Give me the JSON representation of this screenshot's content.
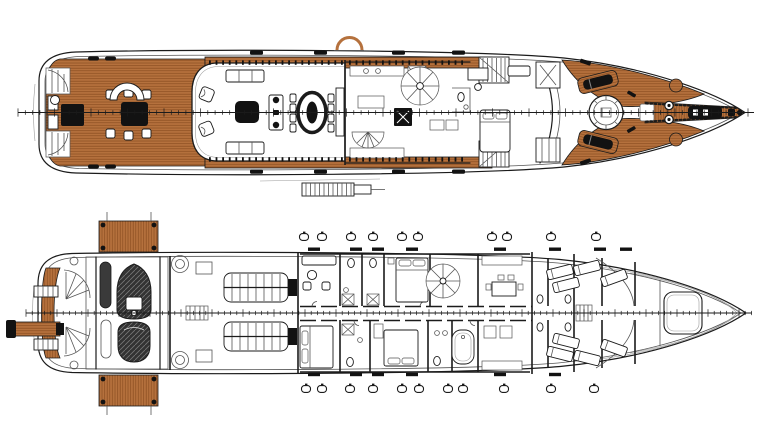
{
  "document": {
    "kind": "yacht-general-arrangement-plan",
    "decks_shown": 2
  },
  "colors": {
    "paper": "#ffffff",
    "line_dark": "#1b1b1b",
    "line_mid": "#555555",
    "line_light": "#999999",
    "teak": "#b5713d",
    "teak_stripe": "#8a4d20",
    "dark_fill": "#121212",
    "cover_fill": "#333333",
    "cover_hatch": "#777777"
  },
  "main_deck": {
    "name": "main-deck-plan",
    "centerline": {
      "y": 112.5,
      "x1": 18,
      "x2": 754,
      "tick_step": 7.3,
      "tick_len": 4.6
    },
    "window_bands": [
      {
        "y": 60.4,
        "x1": 209,
        "x2": 342,
        "step": 6.6,
        "w": 1.8,
        "h": 4.4
      },
      {
        "y": 157.2,
        "x1": 209,
        "x2": 342,
        "step": 6.6,
        "w": 1.8,
        "h": 4.4
      },
      {
        "y": 60.4,
        "x1": 349,
        "x2": 466,
        "step": 6.6,
        "w": 1.8,
        "h": 4.4
      },
      {
        "y": 157.2,
        "x1": 349,
        "x2": 466,
        "step": 6.6,
        "w": 1.8,
        "h": 4.4
      }
    ],
    "deck_fittings": {
      "top_y": 50.5,
      "bottom_y": 169.5,
      "xs": [
        250,
        314,
        392,
        452
      ],
      "w": 13,
      "h": 4.2
    },
    "sheer_pills": {
      "top_y": 56.5,
      "bottom_y": 164.5,
      "xs": [
        88,
        105
      ],
      "w": 11,
      "h": 4
    }
  },
  "lower_deck": {
    "name": "lower-deck-plan",
    "centerline": {
      "y": 313,
      "x1": 26,
      "x2": 752,
      "tick_step": 6.2,
      "tick_len": 4.2
    },
    "portholes": {
      "rx": 4.5,
      "ry": 3.4,
      "top": {
        "y": 237,
        "xs": [
          304,
          322,
          351,
          373,
          402,
          418,
          492,
          507,
          551,
          596
        ]
      },
      "bottom": {
        "y": 389,
        "xs": [
          306,
          322,
          350,
          373,
          402,
          419,
          448,
          463,
          504,
          551,
          594
        ]
      }
    },
    "hull_hatches": {
      "top": {
        "y": 247.5,
        "xs": [
          308,
          350,
          372,
          406,
          494,
          549,
          594,
          620
        ],
        "w": 12,
        "h": 3.4
      },
      "bottom": {
        "y": 372.8,
        "xs": [
          308,
          350,
          372,
          406,
          494,
          549
        ],
        "w": 12,
        "h": 3.4
      }
    }
  }
}
